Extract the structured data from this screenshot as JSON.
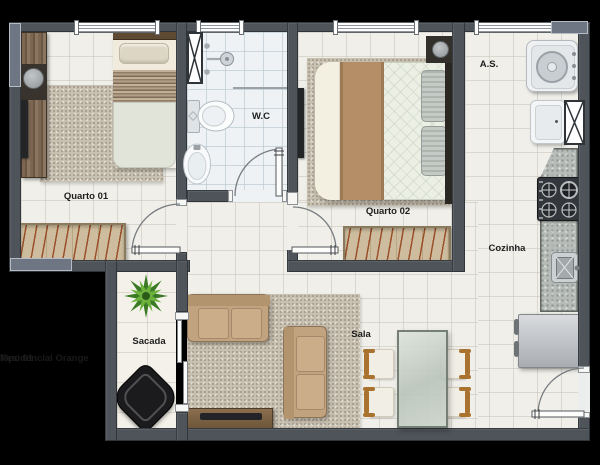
{
  "watermark": {
    "line1": "Residencial Orange",
    "line2": "Tipo 01"
  },
  "rooms": {
    "quarto01": {
      "label": "Quarto 01"
    },
    "wc": {
      "label": "W.C"
    },
    "quarto02": {
      "label": "Quarto 02"
    },
    "area_servico": {
      "label": "A.S."
    },
    "cozinha": {
      "label": "Cozinha"
    },
    "sala": {
      "label": "Sala"
    },
    "sacada": {
      "label": "Sacada"
    }
  },
  "colors": {
    "background": "#000000",
    "wall": "#4e545a",
    "floor": "#f0efe9",
    "bathroom_floor": "#eef2f4",
    "balcony_floor": "#f3f1e9",
    "wood_furniture": "#7d6752",
    "wardrobe_wood": "#cdbd9e",
    "sofa": "#c2a37f",
    "bed_runner": "#b58e67",
    "counter_granite": "#b6bbb7",
    "plant_green": "#4e8a2e",
    "label_text": "#1e1e1e"
  }
}
